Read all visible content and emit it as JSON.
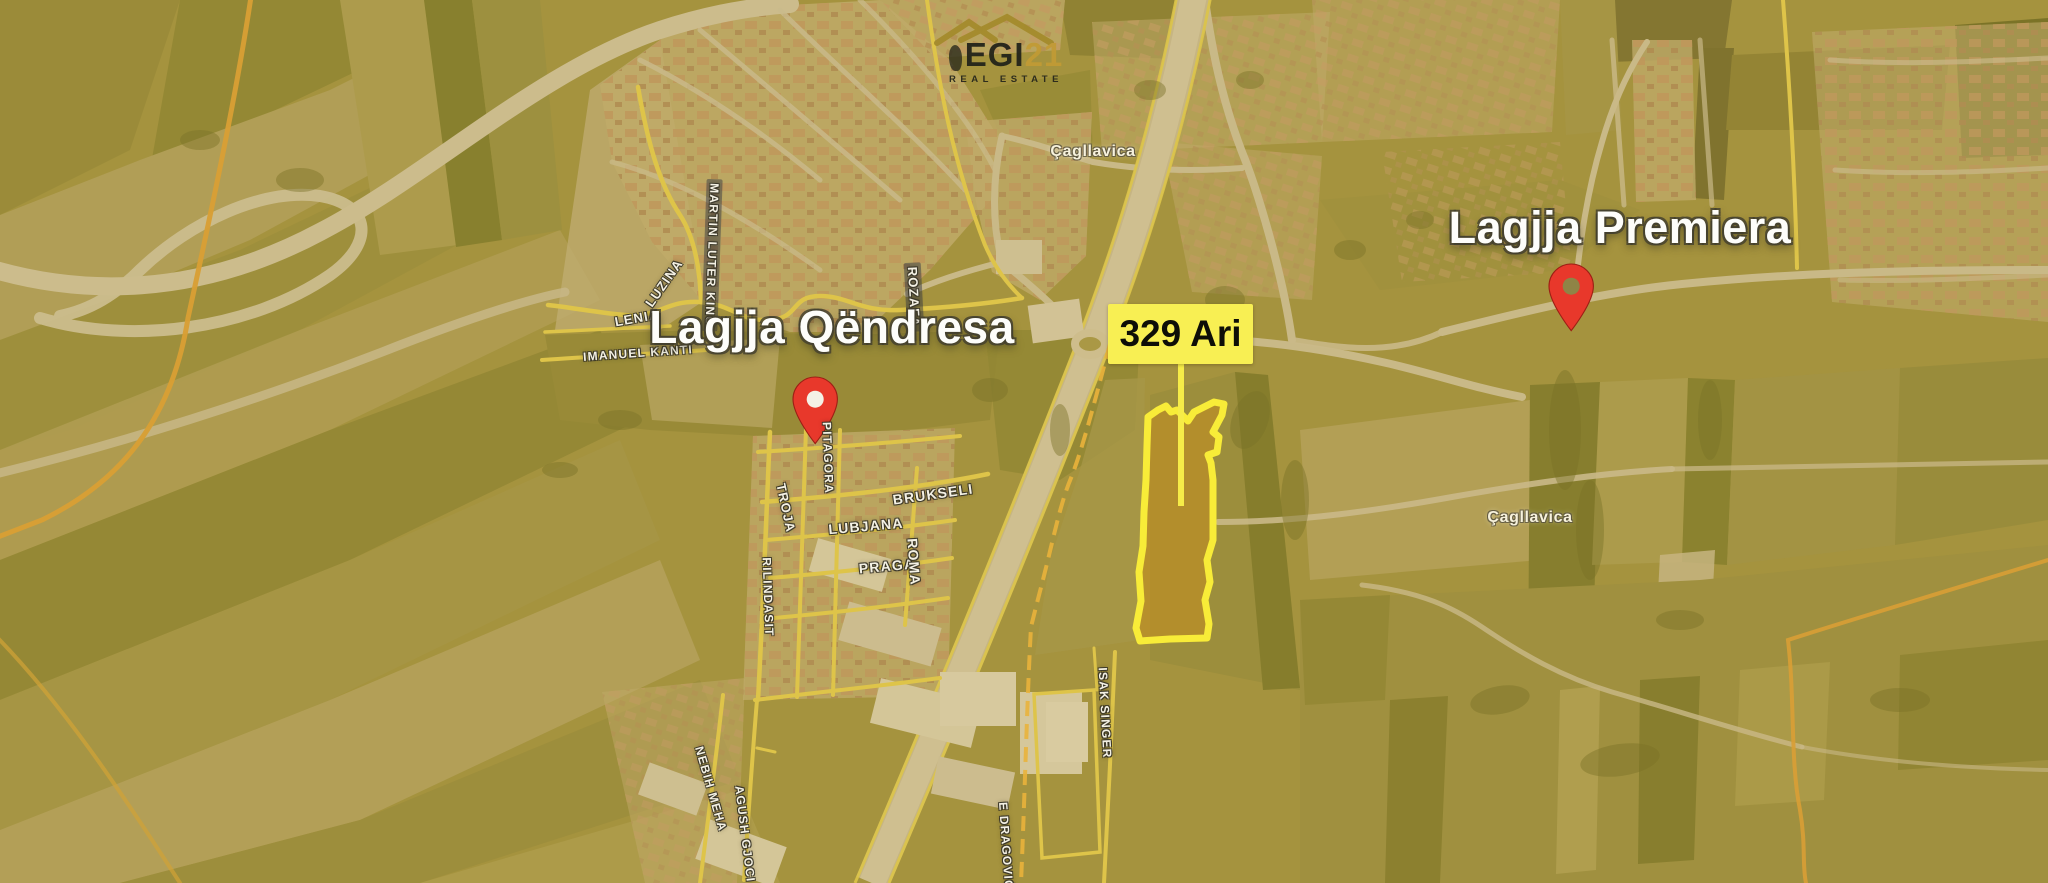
{
  "logo": {
    "name": "EGI",
    "number": "21",
    "subtitle": "REAL ESTATE"
  },
  "markers": {
    "qendresa": {
      "title": "Lagjja Qëndresa"
    },
    "premiera": {
      "title": "Lagjja Premiera"
    }
  },
  "parcel": {
    "tag": "329 Ari"
  },
  "towns": {
    "town_1": "Çagllavica",
    "town_2": "Çagllavica"
  },
  "streets": {
    "martin_luter_king": "MARTIN LUTER KING",
    "luzina": "LUZINA",
    "lenia": "LENIA",
    "imanuel_kanti": "IMANUEL KANTI",
    "rozafa": "ROZAFA",
    "pitagora": "PITAGORA",
    "troja": "TROJA",
    "rilindasit": "RILINDASIT",
    "brukseli": "BRUKSELI",
    "lubjana": "LUBJANA",
    "praga": "PRAGA",
    "roma": "ROMA",
    "isak_singer": "ISAK SINGER",
    "nebih_meha": "NEBIH MEHA",
    "agush_gjoci": "AGUSH GJOCI",
    "e_dragovic": "E DRAGOVIĆ"
  },
  "colors": {
    "pin_red": "#E8382B",
    "parcel_outline": "#F8EC38",
    "parcel_fill": "#C9901C",
    "tag_background": "#F8EF53",
    "logo_gold": "#C19A35",
    "boundary_orange": "#E2A238"
  }
}
